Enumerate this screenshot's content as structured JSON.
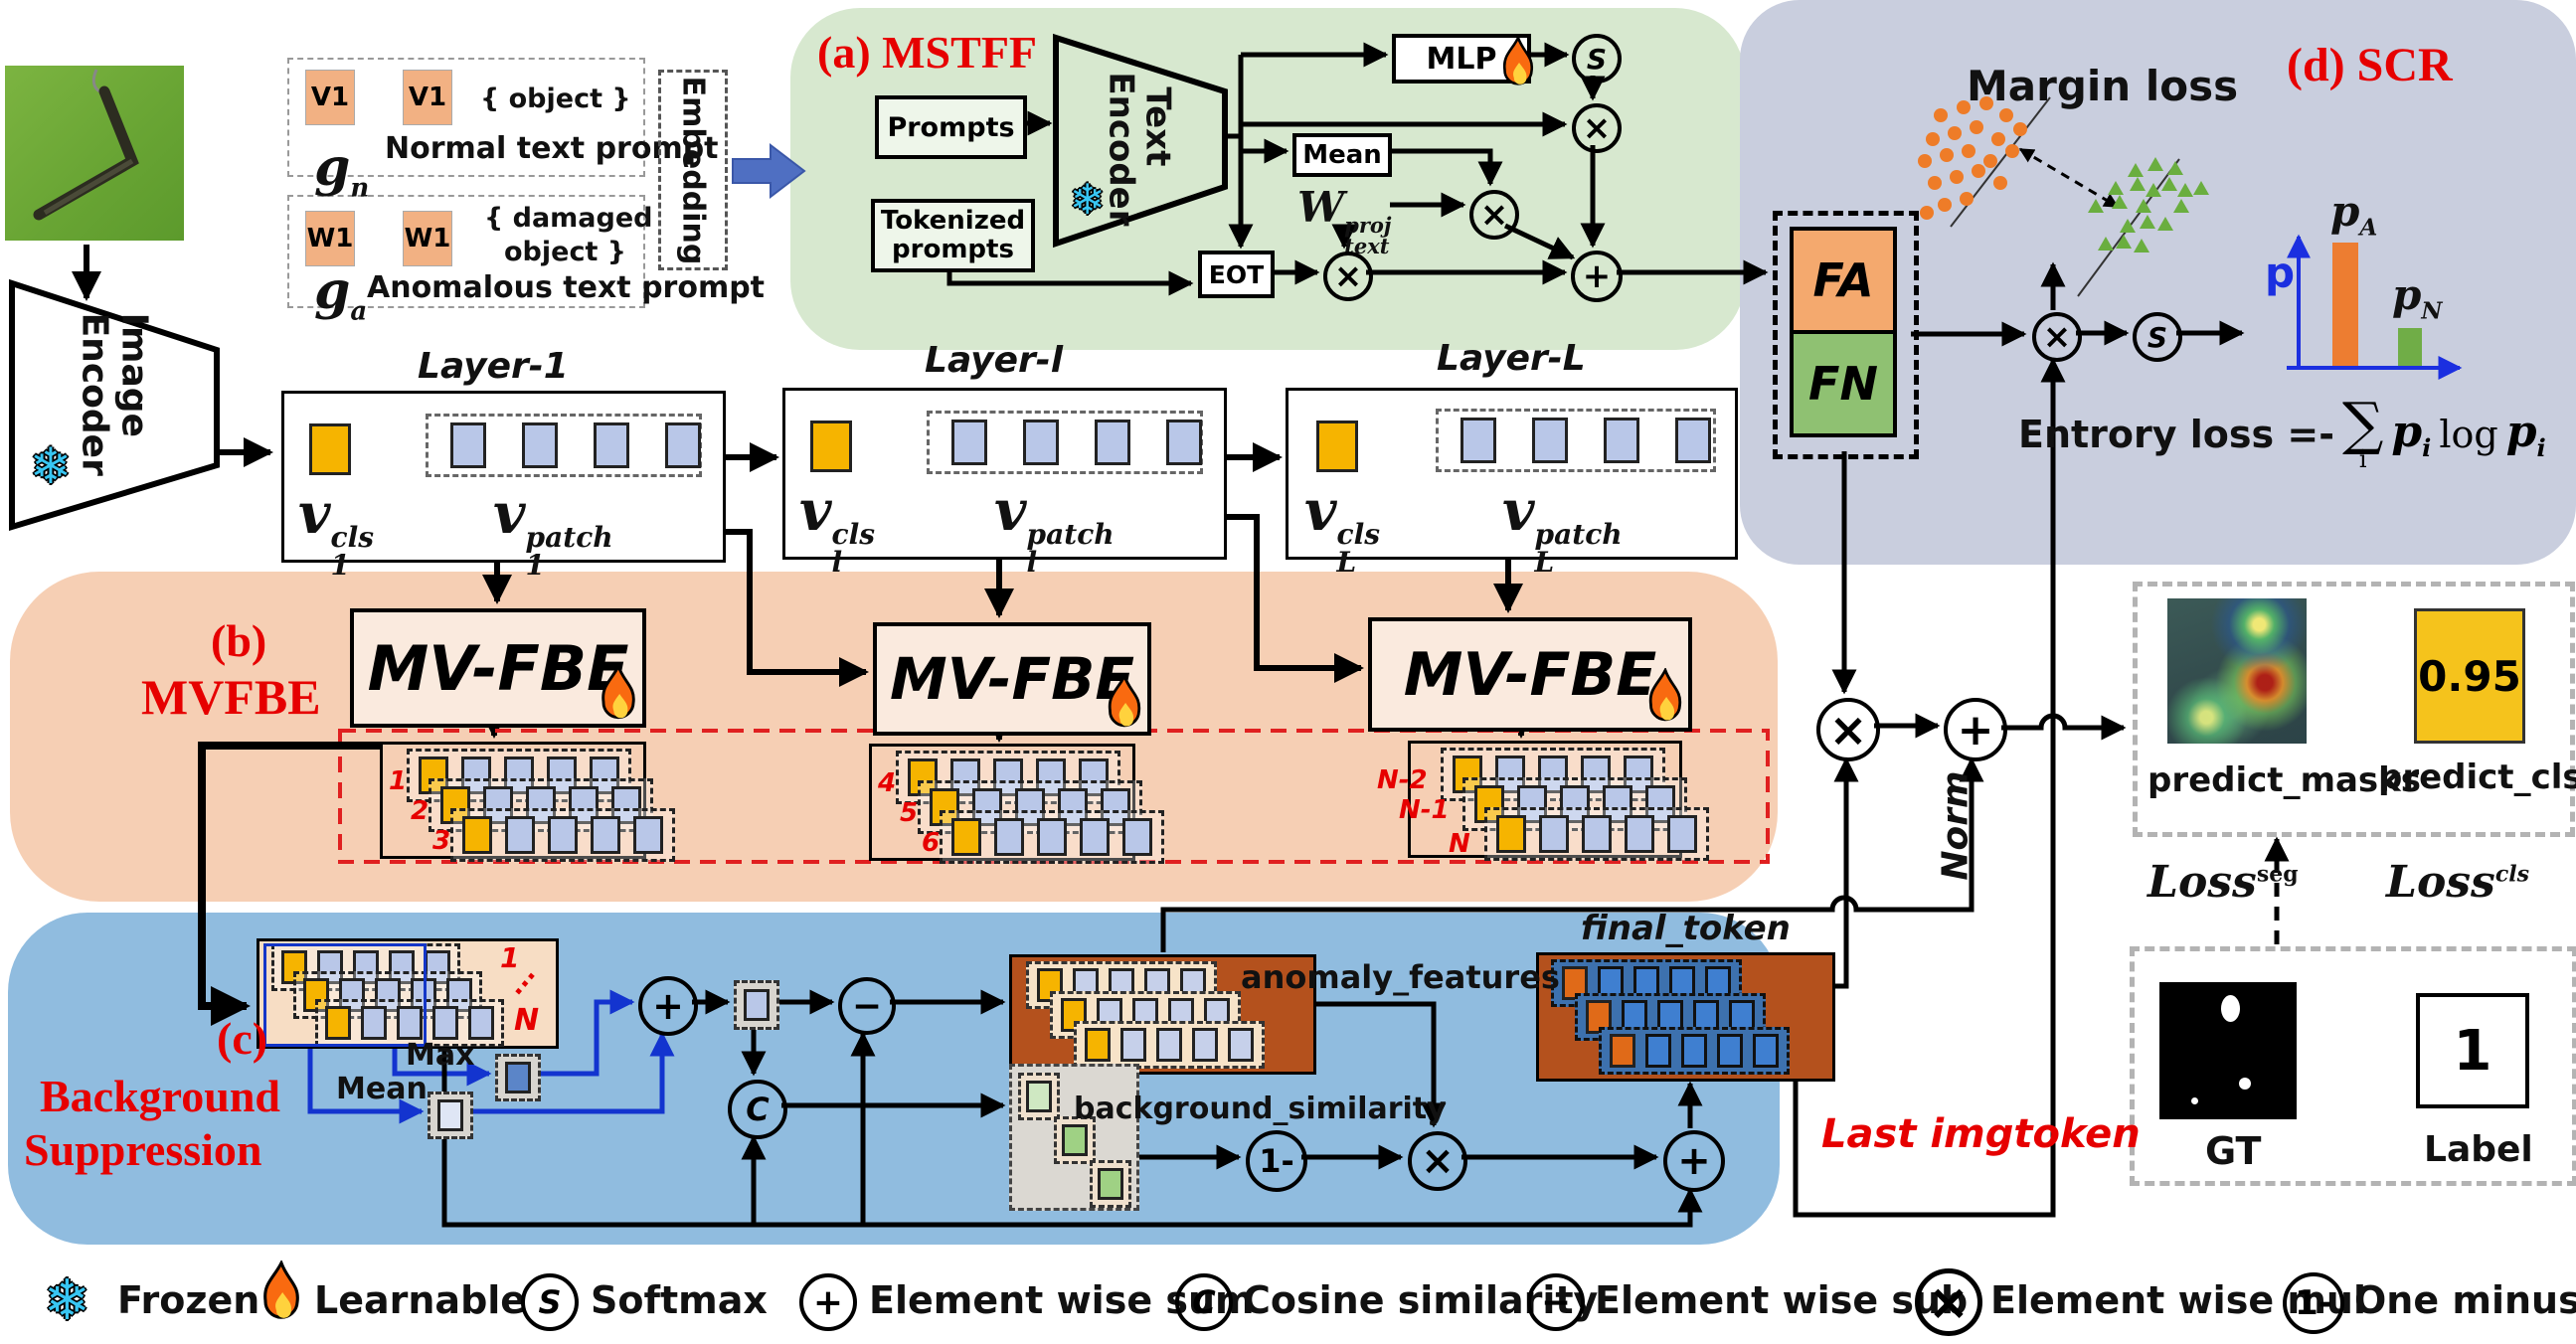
{
  "t": {
    "a": "(a) MSTFF",
    "b1": "(b)",
    "b2": "MVFBE",
    "c1": "(c)",
    "c2": "Background",
    "c3": "Suppression",
    "d": "(d) SCR"
  },
  "pr": {
    "v1a": "V1",
    "v1b": "V1",
    "obj": "{ object }",
    "normal": "Normal text prompt",
    "gn": {
      "base": "g",
      "sub": "n"
    },
    "w1a": "W1",
    "w1b": "W1",
    "dmg1": "{ damaged",
    "dmg2": "object }",
    "anom": "Anomalous text prompt",
    "ga": {
      "base": "g",
      "sub": "a"
    },
    "embedding": "Embedding"
  },
  "enc": {
    "img1": "Image",
    "img2": "Encoder",
    "txt1": "Text",
    "txt2": "Encoder"
  },
  "ms": {
    "prompts": "Prompts",
    "tok1": "Tokenized",
    "tok2": "prompts",
    "mlp": "MLP",
    "mean": "Mean",
    "eot": "EOT",
    "w": {
      "base": "W",
      "sub": "text",
      "sup": "proj"
    }
  },
  "op": {
    "s": "S",
    "mul": "×",
    "plus": "+",
    "minus": "−",
    "cos": "C",
    "om": "1-"
  },
  "layers": [
    {
      "title": "Layer-1",
      "cls": {
        "base": "v",
        "sub": "1",
        "sup": "cls"
      },
      "patch": {
        "base": "v",
        "sub": "1",
        "sup": "patch"
      }
    },
    {
      "title": "Layer-l",
      "cls": {
        "base": "v",
        "sub": "l",
        "sup": "cls"
      },
      "patch": {
        "base": "v",
        "sub": "l",
        "sup": "patch"
      }
    },
    {
      "title": "Layer-L",
      "cls": {
        "base": "v",
        "sub": "L",
        "sup": "cls"
      },
      "patch": {
        "base": "v",
        "sub": "L",
        "sup": "patch"
      }
    }
  ],
  "fbe": {
    "label": "MV-FBE",
    "g": [
      [
        "1",
        "2",
        "3"
      ],
      [
        "4",
        "5",
        "6"
      ],
      [
        "N-2",
        "N-1",
        "N"
      ]
    ]
  },
  "bs": {
    "in1": "1",
    "dots": "...",
    "inN": "N",
    "max": "Max",
    "mean": "Mean",
    "anomaly": "anomaly_features",
    "bg": "background_similarity",
    "final": "final_token",
    "norm": "Norm",
    "last": "Last imgtoken"
  },
  "scr": {
    "margin": "Margin loss",
    "fa": "FA",
    "fn": "FN",
    "p": "p",
    "pa": {
      "base": "p",
      "sub": "A"
    },
    "pn": {
      "base": "p",
      "sub": "N"
    },
    "ent": "Entrory loss =-",
    "sum": "∑",
    "sumsub": "i",
    "pi": {
      "base": "p",
      "sub": "i"
    },
    "log": "log",
    "pi2": {
      "base": "p",
      "sub": "i"
    }
  },
  "out": {
    "pm": "predict_masks",
    "pc": "predict_cls",
    "score": "0.95",
    "lseg": {
      "base": "Loss",
      "sup": "seg"
    },
    "lcls": {
      "base": "Loss",
      "sup": "cls"
    },
    "gt": "GT",
    "one": "1",
    "label": "Label"
  },
  "legend": [
    {
      "icon": "snowflake-icon",
      "glyph": "❄",
      "label": "Frozen"
    },
    {
      "icon": "flame-icon",
      "glyph": "",
      "label": "Learnable"
    },
    {
      "icon": "softmax-icon",
      "glyph": "S",
      "label": "Softmax"
    },
    {
      "icon": "sum-icon",
      "glyph": "+",
      "label": "Element wise sum"
    },
    {
      "icon": "cosine-icon",
      "glyph": "C",
      "label": "Cosine similarity"
    },
    {
      "icon": "sub-icon",
      "glyph": "−",
      "label": "Element wise sub"
    },
    {
      "icon": "mul-icon",
      "glyph": "×",
      "label": "Element wise mul"
    },
    {
      "icon": "one-minus-icon",
      "glyph": "1-",
      "label": "One minus ×"
    }
  ],
  "chart_data": {
    "type": "bar",
    "categories": [
      "p_A",
      "p_N"
    ],
    "values": [
      0.9,
      0.27
    ],
    "ylabel": "p",
    "ylim": [
      0,
      1
    ],
    "colors": [
      "#ed7d31",
      "#70ad47"
    ],
    "legend_position": "none",
    "grid": false
  }
}
